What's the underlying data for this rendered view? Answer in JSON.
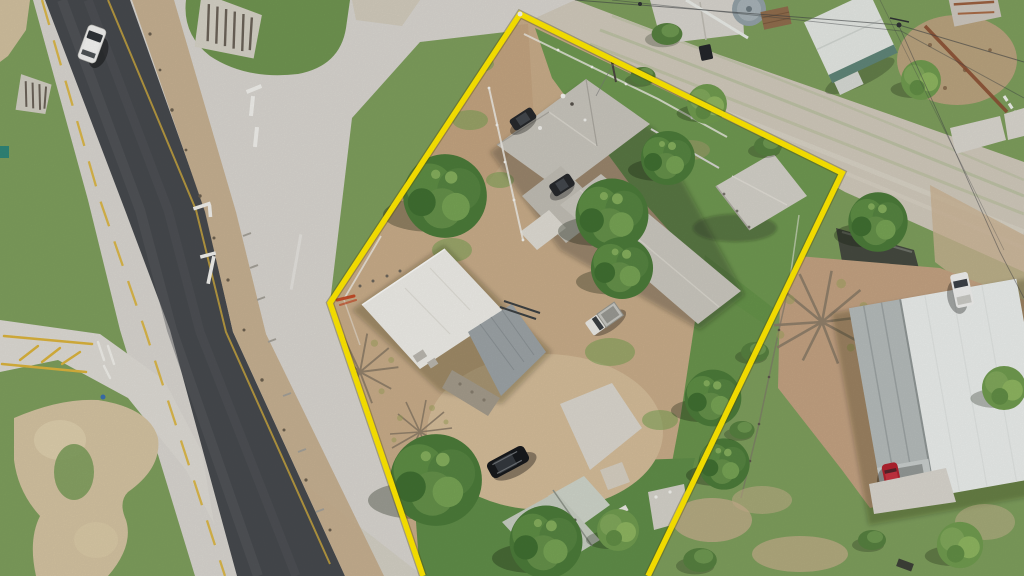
{
  "scene": {
    "description": "Aerial drone photograph of a corner lot outlined with a yellow property-boundary overlay, at the junction of a dark asphalt highway and a light concrete cross street",
    "boundary": {
      "points": "423,576 330,303 520,14 842,173 648,576",
      "color": "#ffe800"
    },
    "elements": [
      "highway",
      "cross-street",
      "gravel-street",
      "grass-island",
      "culvert-grates",
      "main-house",
      "flat-roof-building",
      "metal-roof-section",
      "carport",
      "old-shed",
      "storage-shed",
      "water-tank",
      "neighbor-house",
      "power-lines",
      "trees",
      "bare-trees",
      "concrete-slabs",
      "road-markings"
    ]
  },
  "colors": {
    "asphalt": "#46494d",
    "concrete": "#d7d4ce",
    "gravel_street": "#cfc8ba",
    "grass": "#7d9d5c",
    "grass_dark": "#6e9750",
    "island_green": "#6f9450",
    "dirt": "#c7ab88",
    "dirt_neighbor": "#c2a181",
    "tan_strip": "#c3ab8b",
    "roof_main": "#c7c4bb",
    "roof_flat_white": "#ecebe6",
    "roof_metal": "#9ba2a5",
    "carport": "#d2cfc7",
    "shed_old": "#c6ccc1",
    "shed_white": "#e3e6e2",
    "shed_trim": "#5f8578",
    "neighbor_metal": "#b4bab9",
    "neighbor_white": "#e9ecea",
    "tank": "#93a0a6",
    "lane_yellow": "#d9b23c",
    "marking_white": "#efeeea",
    "vehicle_white": "#eeeeec",
    "vehicle_black": "#17191c",
    "dark_car": "#26282b",
    "pickup_white": "#e9e8e4",
    "car_red": "#b1222e",
    "tree_dark": "#4b7a39",
    "tree_mid": "#5d8c44",
    "tree_light": "#76a254",
    "bare_branch": "#8a7a66",
    "rust_fence": "#8a4f33",
    "orange_pipe": "#c24b28"
  },
  "vehicles": {
    "white_suv_highway": {
      "transform": "translate(92,44) rotate(20)"
    },
    "dark_car_upper": {
      "transform": "translate(523,119) rotate(-33)"
    },
    "dark_car_lower": {
      "transform": "translate(562,185) rotate(-33)"
    },
    "black_suv_yard": {
      "transform": "translate(508,462) rotate(-28)"
    },
    "white_pickup_yard": {
      "transform": "translate(604,319) rotate(-35)"
    },
    "white_truck_neighbor": {
      "transform": "translate(962,290) rotate(-12)"
    },
    "red_car_neighbor": {
      "transform": "translate(892,478) rotate(-12)"
    }
  },
  "trees": {
    "t1": {
      "variant": "tree1",
      "transform": "translate(445,196) scale(1.55)"
    },
    "t2": {
      "variant": "tree1",
      "transform": "translate(612,215) scale(1.35)"
    },
    "t2b": {
      "variant": "tree1",
      "transform": "translate(622,268) scale(1.15)"
    },
    "t3": {
      "variant": "tree1",
      "transform": "translate(668,158) scale(1.0)"
    },
    "t4": {
      "variant": "tree2",
      "transform": "translate(707,104) scale(0.95)"
    },
    "t5": {
      "variant": "tree1",
      "transform": "translate(436,480) scale(1.7)"
    },
    "t6": {
      "variant": "tree1",
      "transform": "translate(546,542) scale(1.35)"
    },
    "t7": {
      "variant": "tree2",
      "transform": "translate(618,530) scale(1.0)"
    },
    "t8": {
      "variant": "tree1",
      "transform": "translate(713,398) scale(1.05)"
    },
    "t9": {
      "variant": "tree1",
      "transform": "translate(724,464) scale(0.95)"
    },
    "t10": {
      "variant": "bush",
      "transform": "translate(700,560) scale(1.2)"
    },
    "t11": {
      "variant": "tree2",
      "transform": "translate(921,80) scale(0.95)"
    },
    "t12": {
      "variant": "tree2",
      "transform": "translate(1004,388) scale(1.05)"
    },
    "t13": {
      "variant": "bush",
      "transform": "translate(667,34) scale(1.1)"
    },
    "t14": {
      "variant": "bush",
      "transform": "translate(768,146) scale(1.0)"
    },
    "t15": {
      "variant": "tree1",
      "transform": "translate(878,222) scale(1.1)"
    },
    "t16": {
      "variant": "bush",
      "transform": "translate(755,352) scale(1.0)"
    },
    "t17": {
      "variant": "bush",
      "transform": "translate(742,430) scale(0.9)"
    },
    "t18": {
      "variant": "tree2",
      "transform": "translate(960,545) scale(1.1)"
    },
    "t19": {
      "variant": "bush",
      "transform": "translate(872,540) scale(1.0)"
    },
    "t20": {
      "variant": "bush",
      "transform": "translate(643,76) scale(0.9)"
    }
  },
  "bare_trees": {
    "b1": {
      "transform": "translate(360,372) scale(1.2)"
    },
    "b2": {
      "transform": "translate(822,322) scale(1.6)"
    },
    "b3": {
      "transform": "translate(420,432) scale(1.0)"
    }
  }
}
